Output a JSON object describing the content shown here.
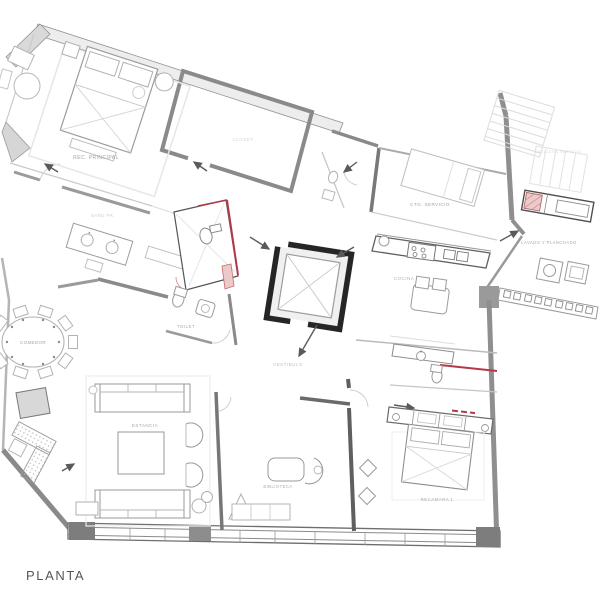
{
  "drawing": {
    "type": "architectural-floor-plan",
    "title": "PLANTA"
  },
  "rooms": [
    {
      "name": "rec-principal",
      "label": "REC. PRINCIPAL"
    },
    {
      "name": "closet",
      "label": "CLOSET"
    },
    {
      "name": "bano-principal",
      "label": "BAÑO PR."
    },
    {
      "name": "cto-servicio",
      "label": "CTO. SERVICIO"
    },
    {
      "name": "escalera-servicio",
      "label": "ESCALERA SERVICIO"
    },
    {
      "name": "lavado-planchado",
      "label": "LAVADO Y PLANCHADO"
    },
    {
      "name": "cocina",
      "label": "COCINA"
    },
    {
      "name": "vestibulo",
      "label": "VESTIBULO"
    },
    {
      "name": "toilet",
      "label": "TOILET"
    },
    {
      "name": "comedor",
      "label": "COMEDOR"
    },
    {
      "name": "estancia",
      "label": "ESTANCIA"
    },
    {
      "name": "biblioteca",
      "label": "BIBLIOTECA"
    },
    {
      "name": "recamara-1",
      "label": "RECAMARA 1"
    }
  ],
  "colors": {
    "paper": "#ffffff",
    "wall_gray": "#8f8f8f",
    "wall_dark": "#5a5a5a",
    "core_black": "#262626",
    "furniture_gray": "#9a9a9a",
    "accent_red": "#b23a48",
    "accent_red_light": "#eccaca",
    "label_gray": "#a3a3a3",
    "faint_gray": "#d2d2d2",
    "title_gray": "#565656"
  }
}
